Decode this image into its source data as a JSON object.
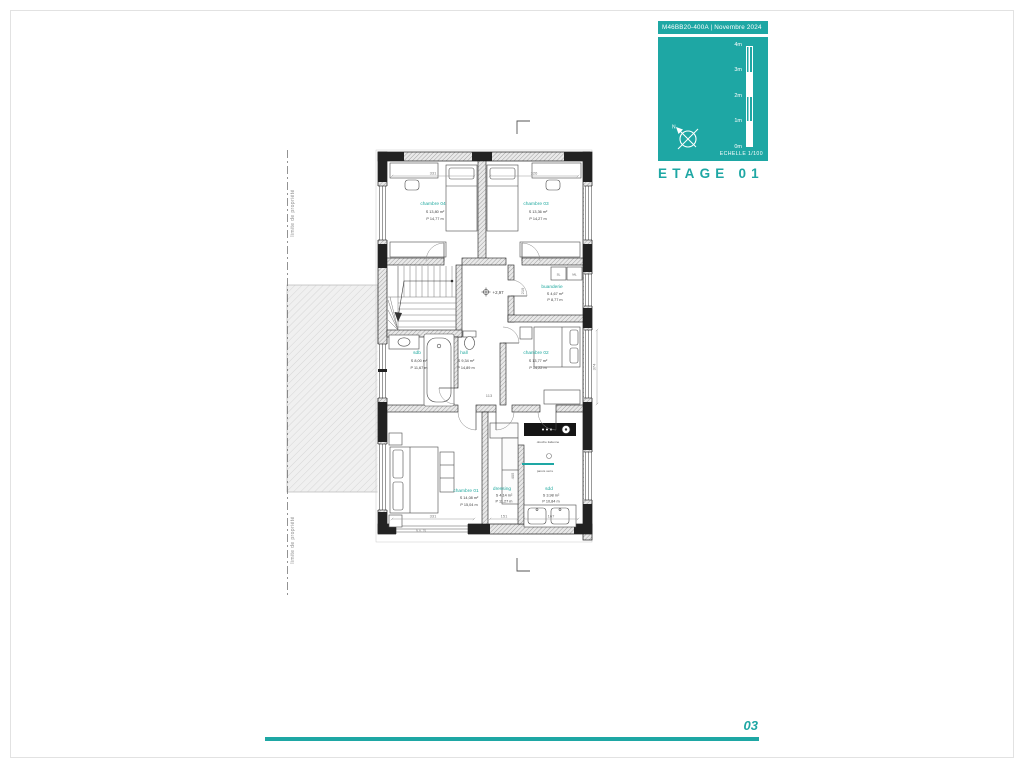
{
  "colors": {
    "accent": "#1ea7a4",
    "room_label": "#21a99f",
    "wall_dark": "#1a1a1a"
  },
  "title_block": {
    "project_code": "M46BB20-400A  | Novembre 2024",
    "floor_title": "ETAGE 01",
    "scale_label": "ECHELLE  1/100",
    "scale_ticks": [
      "4m",
      "3m",
      "2m",
      "1m",
      "0m"
    ],
    "north": "N"
  },
  "footer": {
    "page": "03"
  },
  "plan": {
    "property_label": "limite de propriété",
    "level": "+2,97",
    "rooms": [
      {
        "name": "chambre 04",
        "area": "S  13,80 m²",
        "perim": "P  14,77 m"
      },
      {
        "name": "chambre 03",
        "area": "S  13,36 m²",
        "perim": "P  14,27 m"
      },
      {
        "name": "buanderie",
        "area": "S  4,67 m²",
        "perim": "P  8,77 m"
      },
      {
        "name": "sdb",
        "area": "S  8,00 m²",
        "perim": "P  11,67 m"
      },
      {
        "name": "hall",
        "area": "S  9,34 m²",
        "perim": "P  14,89 m"
      },
      {
        "name": "chambre 02",
        "area": "S  13,77 m²",
        "perim": "P  14,22 m"
      },
      {
        "name": "chambre 01",
        "area": "S  14,08 m²",
        "perim": "P  15,04 m"
      },
      {
        "name": "dressing",
        "area": "S  4,14 m²",
        "perim": "P  11,27 m"
      },
      {
        "name": "sdd",
        "area": "S  3,98 m²",
        "perim": "P  10,84 m"
      }
    ],
    "labels": {
      "sl": "SL",
      "ml": "ML",
      "douche": "douche italienne",
      "parois": "parois verre"
    },
    "dims": {
      "top_left": "331",
      "top_right": "326",
      "bottom_left": "331",
      "bottom_mid": "151",
      "bottom_right": "167",
      "right_v": "374",
      "dressing_v": "405",
      "buanderie_v": "219",
      "hall_w": "113",
      "na": "N.A. 76"
    }
  }
}
